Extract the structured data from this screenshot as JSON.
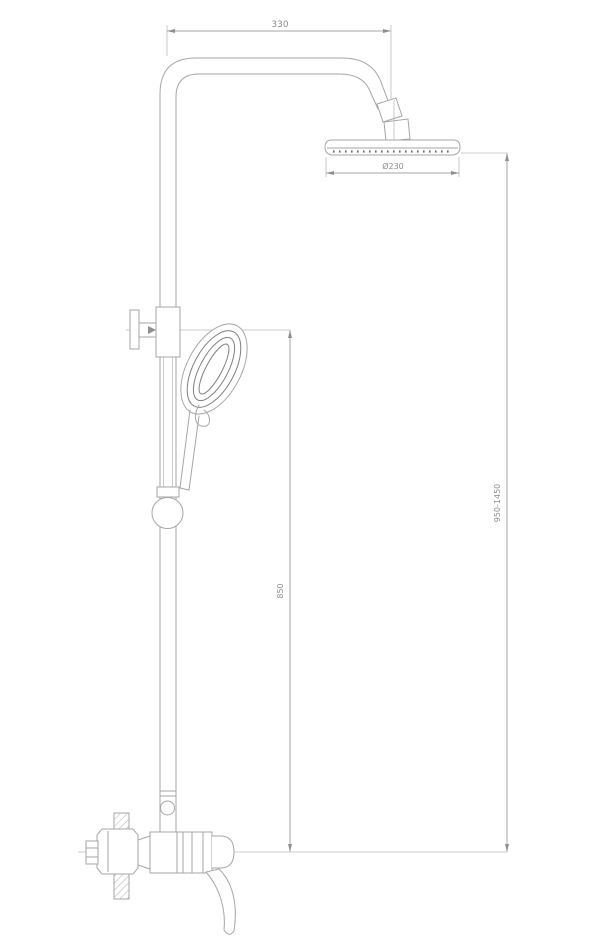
{
  "drawing": {
    "dimensions": {
      "arm_length": "330",
      "head_diameter": "Ø230",
      "height_range": "950-1450",
      "riser_height": "850"
    },
    "colors": {
      "background": "#ffffff",
      "line": "#a6a6a6",
      "detail_line": "#7f7f7f",
      "dimension_text": "#8c8c8c"
    }
  }
}
